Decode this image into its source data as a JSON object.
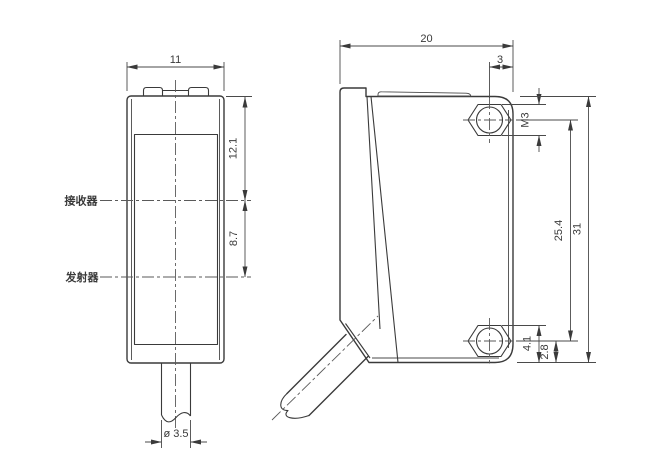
{
  "drawing": {
    "front_view": {
      "label_receiver": "接收器",
      "label_emitter": "发射器",
      "dim_width": "11",
      "dim_top_to_receiver": "12.1",
      "dim_receiver_to_emitter": "8.7",
      "dim_cable_diameter": "ø 3.5"
    },
    "side_view": {
      "dim_depth": "20",
      "dim_hole_to_edge": "3",
      "dim_thread": "M3",
      "dim_hole_spacing": "25.4",
      "dim_height": "31",
      "dim_hex_to_bottom": "4.1",
      "dim_hole_center_to_bottom": "2.8"
    },
    "colors": {
      "line": "#3a3a3a",
      "background": "#ffffff"
    }
  }
}
